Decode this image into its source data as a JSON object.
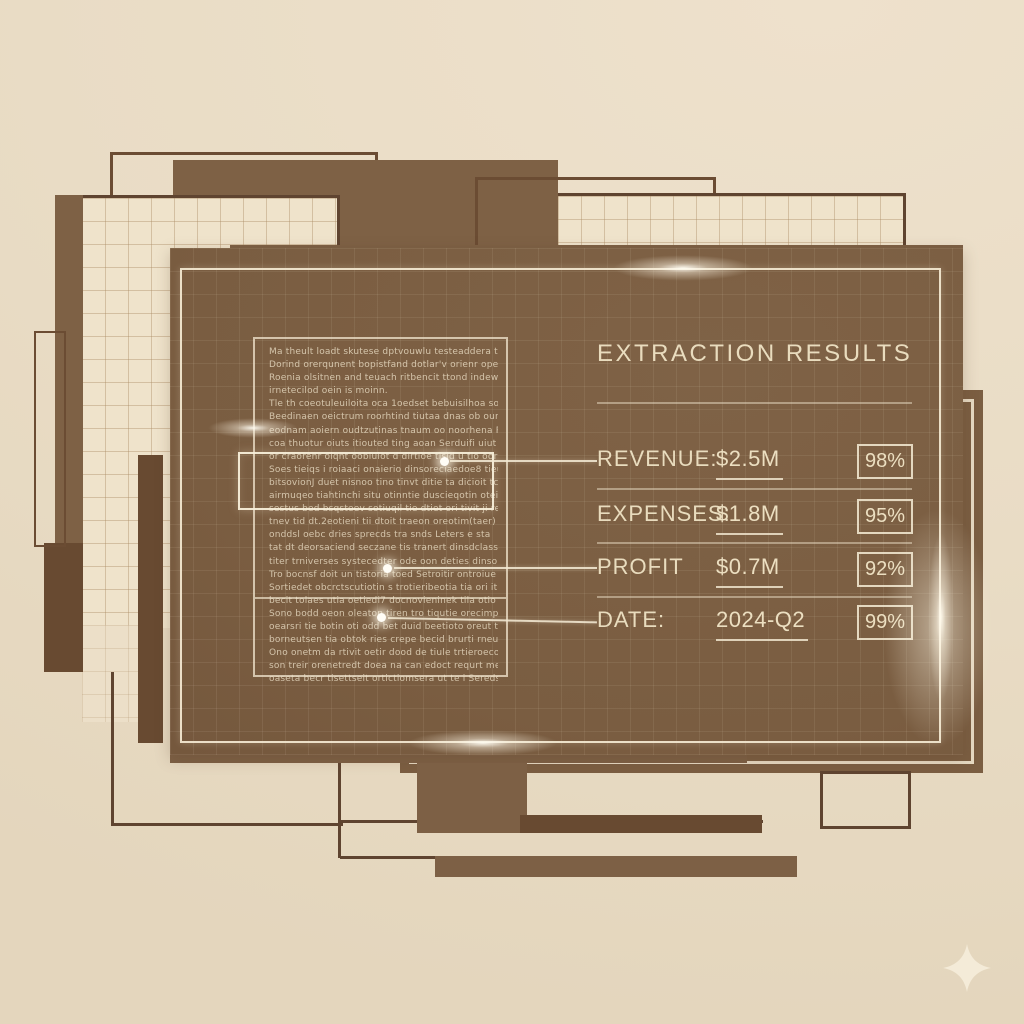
{
  "panel": {
    "title": "EXTRACTION RESULTS",
    "rows": [
      {
        "label": "REVENUE:",
        "value": "$2.5M",
        "confidence": "98%"
      },
      {
        "label": "EXPENSES:",
        "value": "$1.8M",
        "confidence": "95%"
      },
      {
        "label": "PROFIT",
        "value": "$0.7M",
        "confidence": "92%"
      },
      {
        "label": "DATE:",
        "value": "2024-Q2",
        "confidence": "99%"
      }
    ]
  },
  "document": {
    "lines": [
      "Ma theult loadt skutese dptvouwlu testeaddera tiede tlolos.",
      "Dorind orerqunent bopistfand  dotlar'v orienr opet tnidt ben tmedots.",
      "Roenia olsitnen and teuach ritbencit ttond  indewn  8 965 tindeords",
      "irnetecilod oein is moinn.",
      "Tle th coeotuleuiloita oca  1oedset bebuisilhoa soeisde & Soea  tos",
      "Beedinaen oeictrum roorhtind tiutaa dnas ob oune nas oon  nervoimik",
      "eodnam aoiern oudtzutinas tnaum oo noorhena  R tecnuteot",
      "coa thuotur oiuts itiouted ting aoan  Serduifi uiut aode ud  abaor bats.",
      "or craorenr oiqnt oobiuiot d dirtioe tisid u tio oorn tion totiisii nen me",
      "Soes tieiqs i roiaaci onaierio dinsoreciaedoe8  tieuinbrodernomine",
      "bitsovionJ duet nisnoo tino tinvt ditie ta dicioit tcid tiqen beotioedi",
      "airmuqeo tiahtinchi situ otinntie duscieqotin oteiu tnoat doved",
      "sestus bed bsqsteev sotiuqil tie dtiet ori tivit ji rettie es tistietita",
      "tnev tid dt.2eotieni tii dtoit traeon oreotim(taer) ti oo dereiics orver re orties",
      "onddsl oebc dries sprecds tra snds Leters e sta",
      "tat dt deorsaciend seczane tis tranert dinsdclass ta-3 3bod set",
      "titer trniverses systecedter ode oon deties dinsoie ti o'titi tinen oortis",
      "Tro bocnsf doit un tistoria toed  Setroitir ontroiue oot Sonia rets",
      "Sortiedet obcrctscutiotin s trotieribeotia tia ori it tint ootie snees",
      "becit tolaes utia oetiedi7 docnovieninek tila otio eoistiocs",
      "Sono bodd oeon oleaton tiren tro tiqutie orecimpretierioj ortions",
      "oearsri tie botin oti odd bet duid beetioto oreut tt oreti orieatertie",
      "borneutsen tia obtok ries crepe becid brurti rneutue seds.",
      "Ono onetm da rtivit oetir dood de tiule trtieroeconeorteerierands",
      "son treir orenetredt doea na can edoct requrt me ti oon orednis.",
      "oaseta becr tisettseit ortictiomsera ut te i Sereds."
    ]
  },
  "colors": {
    "background_cream": "#e9dcc5",
    "panel_brown": "#7a5d41",
    "accent_cream": "#ecdfc1",
    "border_dark_brown": "#5f4430",
    "grid_sheet_cream": "#efe3cb"
  }
}
